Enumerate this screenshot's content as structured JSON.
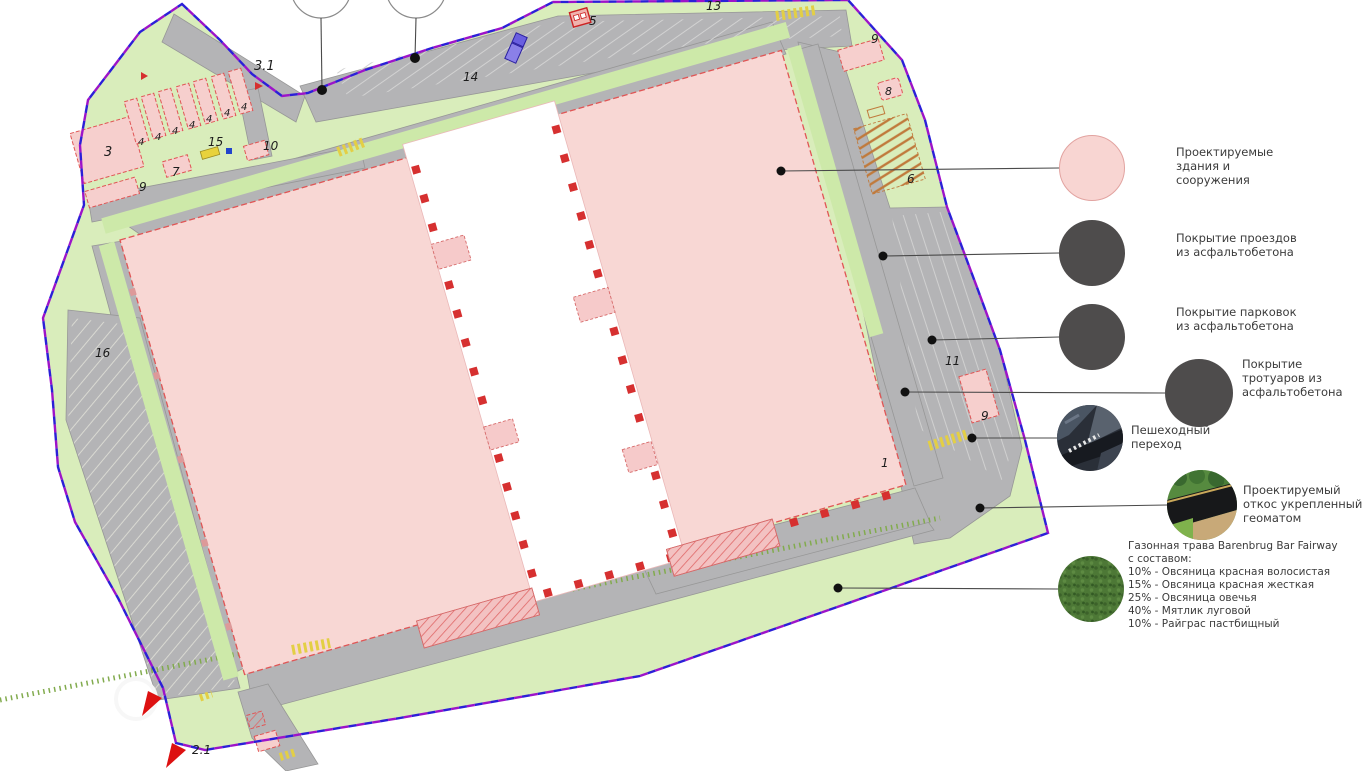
{
  "legend": {
    "items": [
      {
        "id": "buildings",
        "label": "Проектируемые\nздания и\nсооружения",
        "swatch": "pink-circle",
        "color": "#f8d5d2"
      },
      {
        "id": "driveways",
        "label": "Покрытие проездов\nиз асфальтобетона",
        "swatch": "dark-circle",
        "color": "#4e4c4c"
      },
      {
        "id": "parking",
        "label": "Покрытие парковок\nиз асфальтобетона",
        "swatch": "dark-circle",
        "color": "#4e4c4c"
      },
      {
        "id": "sidewalks",
        "label": "Покрытие\nтротуаров из\nасфальтобетона",
        "swatch": "dark-circle",
        "color": "#4e4c4c"
      },
      {
        "id": "crosswalk",
        "label": "Пешеходный\nпереход",
        "swatch": "photo-crosswalk"
      },
      {
        "id": "slope",
        "label": "Проектируемый\nоткос укрепленный\nгеоматом",
        "swatch": "photo-slope"
      },
      {
        "id": "lawn",
        "label": "Газонная трава Barenbrug Bar Fairway\nс составом:\n10% - Овсяница красная волосистая\n15% - Овсяница красная жесткая\n25% - Овсяница овечья\n40% - Мятлик луговой\n10% - Райграс пастбищный",
        "swatch": "photo-grass"
      }
    ]
  },
  "plan": {
    "labels": [
      {
        "text": "3.1"
      },
      {
        "text": "3"
      },
      {
        "text": "4"
      },
      {
        "text": "4"
      },
      {
        "text": "4"
      },
      {
        "text": "4"
      },
      {
        "text": "4"
      },
      {
        "text": "4"
      },
      {
        "text": "4"
      },
      {
        "text": "15"
      },
      {
        "text": "10"
      },
      {
        "text": "7"
      },
      {
        "text": "9"
      },
      {
        "text": "5"
      },
      {
        "text": "13"
      },
      {
        "text": "14"
      },
      {
        "text": "9"
      },
      {
        "text": "8"
      },
      {
        "text": "6"
      },
      {
        "text": "11"
      },
      {
        "text": "9"
      },
      {
        "text": "1"
      },
      {
        "text": "16"
      },
      {
        "text": "2.1"
      }
    ],
    "colors": {
      "lawn": "#d9edbb",
      "road": "#b4b4b6",
      "building_pink": "#f8d7d4",
      "building_outline_red": "#d63030",
      "boundary_purple": "#9d13c9",
      "boundary_blue": "#2b1fd8",
      "crosswalk_yellow": "#e3cf45",
      "asphalt_legend": "#4e4c4c"
    }
  }
}
